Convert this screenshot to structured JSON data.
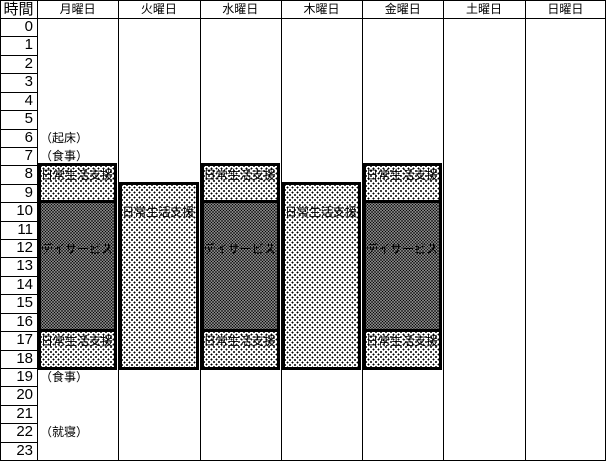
{
  "table": {
    "corner_header": "時間",
    "day_headers": [
      "月曜日",
      "火曜日",
      "水曜日",
      "木曜日",
      "金曜日",
      "土曜日",
      "日曜日"
    ],
    "hour_labels": [
      "0",
      "1",
      "2",
      "3",
      "4",
      "5",
      "6",
      "7",
      "8",
      "9",
      "10",
      "11",
      "12",
      "13",
      "14",
      "15",
      "16",
      "17",
      "18",
      "19",
      "20",
      "21",
      "22",
      "23"
    ],
    "annotations": [
      {
        "hour": 6,
        "text": "（起床）"
      },
      {
        "hour": 7,
        "text": "（食事）"
      },
      {
        "hour": 19,
        "text": "（食事）"
      },
      {
        "hour": 22,
        "text": "（就寝）"
      }
    ],
    "blocks": [
      {
        "day": "月曜日",
        "day_index": 0,
        "label": "日常生活支援",
        "start_hour": 8,
        "end_hour": 10,
        "pattern": "light",
        "label_row": 8
      },
      {
        "day": "月曜日",
        "day_index": 0,
        "label": "デイサービス",
        "start_hour": 10,
        "end_hour": 17,
        "pattern": "dense",
        "label_row": 12
      },
      {
        "day": "月曜日",
        "day_index": 0,
        "label": "日常生活支援",
        "start_hour": 17,
        "end_hour": 19,
        "pattern": "light",
        "label_row": 17
      },
      {
        "day": "火曜日",
        "day_index": 1,
        "label": "日常生活支援",
        "start_hour": 9,
        "end_hour": 19,
        "pattern": "light",
        "label_row": 10
      },
      {
        "day": "水曜日",
        "day_index": 2,
        "label": "日常生活支援",
        "start_hour": 8,
        "end_hour": 10,
        "pattern": "light",
        "label_row": 8
      },
      {
        "day": "水曜日",
        "day_index": 2,
        "label": "デイサービス",
        "start_hour": 10,
        "end_hour": 17,
        "pattern": "dense",
        "label_row": 12
      },
      {
        "day": "水曜日",
        "day_index": 2,
        "label": "日常生活支援",
        "start_hour": 17,
        "end_hour": 19,
        "pattern": "light",
        "label_row": 17
      },
      {
        "day": "木曜日",
        "day_index": 3,
        "label": "日常生活支援",
        "start_hour": 9,
        "end_hour": 19,
        "pattern": "light",
        "label_row": 10
      },
      {
        "day": "金曜日",
        "day_index": 4,
        "label": "日常生活支援",
        "start_hour": 8,
        "end_hour": 10,
        "pattern": "light",
        "label_row": 8
      },
      {
        "day": "金曜日",
        "day_index": 4,
        "label": "デイサービス",
        "start_hour": 10,
        "end_hour": 17,
        "pattern": "dense",
        "label_row": 12
      },
      {
        "day": "金曜日",
        "day_index": 4,
        "label": "日常生活支援",
        "start_hour": 17,
        "end_hour": 19,
        "pattern": "light",
        "label_row": 17
      }
    ]
  },
  "colors": {
    "grid": "#000000",
    "background": "#ffffff",
    "text": "#000000",
    "pattern_dot": "#000000"
  }
}
